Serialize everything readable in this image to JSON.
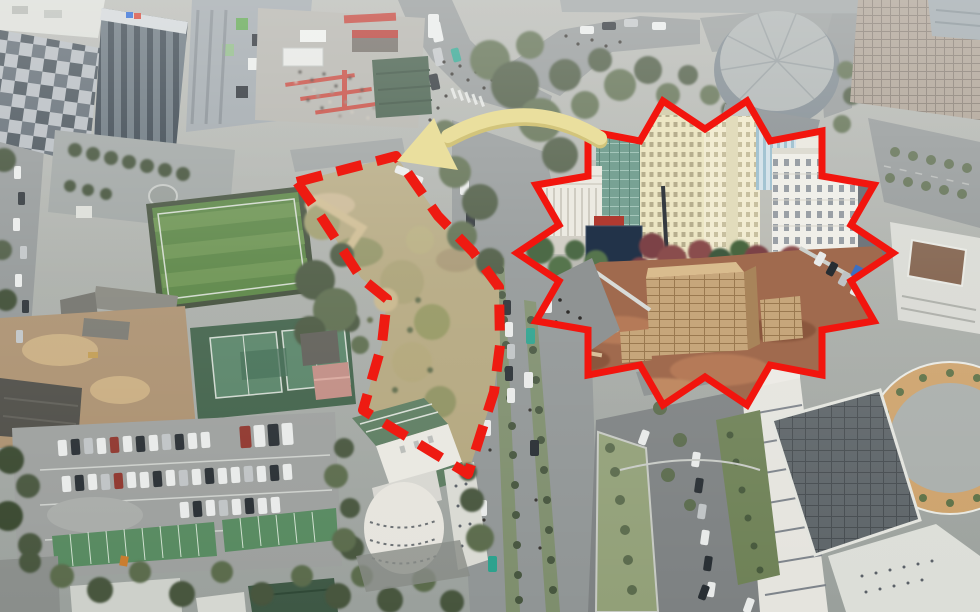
{
  "image": {
    "kind": "annotated aerial drone photograph",
    "description": "Hazy aerial view of an urban block: office towers and an event crowd top-left, a football field, tennis courts and a full parking lot on the left, a tree-lined boulevard through the center, a round auditorium and high-rises top-right, a government complex with a circular tan courtyard bottom-right. A vacant overgrown plot in the center is outlined with a thick red dashed boundary. A pale yellow curved arrow points from a jagged-edged red inset photo (street-level view of the same plot as a fenced construction ground with stacked bricks, apartment towers and ornate white buildings) toward the vacant plot.",
    "width_px": 980,
    "height_px": 612
  },
  "annotations": {
    "boundary": {
      "name": "vacant-lot-dashed-boundary",
      "style": "dashed",
      "color": "#ee1b12"
    },
    "arrow": {
      "name": "inset-to-site-arrow",
      "color": "#eadf9e",
      "shadow_color": "#d2c47b",
      "points_to": "vacant lot"
    },
    "inset": {
      "name": "site-closeup-inset",
      "border_style": "jagged starburst",
      "border_color": "#f2150e"
    }
  },
  "scene": {
    "landmarks": [
      {
        "name": "office-towers",
        "area": "top-left"
      },
      {
        "name": "event-crowd-plaza",
        "area": "top-center"
      },
      {
        "name": "football-field",
        "area": "mid-left"
      },
      {
        "name": "tennis-courts",
        "area": "lower-left"
      },
      {
        "name": "parking-lot",
        "area": "bottom-left"
      },
      {
        "name": "round-auditorium",
        "area": "top-right"
      },
      {
        "name": "high-rise-tower",
        "area": "top-right-corner"
      },
      {
        "name": "tree-lined-boulevard",
        "area": "center"
      },
      {
        "name": "white-building-green-roof",
        "area": "bottom-center"
      },
      {
        "name": "government-complex-circular-courtyard",
        "area": "bottom-right"
      },
      {
        "name": "vacant-lot",
        "area": "center"
      }
    ],
    "inset_contents": [
      "white classical building with columns",
      "green glass mid-rise",
      "cream apartment slab towers",
      "blue-white apartment towers",
      "ornate white colonial building",
      "maroon and green street trees",
      "fenced red-brown construction ground",
      "stacked brick pallets",
      "row of parked cars"
    ]
  },
  "palette": {
    "haze": "#c6c9c3",
    "road": "#8f9494",
    "field_green": "#55813f",
    "court_green": "#568266",
    "courtyard_tan": "#cda26b",
    "brick_tan": "#c6a67b",
    "dirt_brown": "#a06a4e"
  }
}
